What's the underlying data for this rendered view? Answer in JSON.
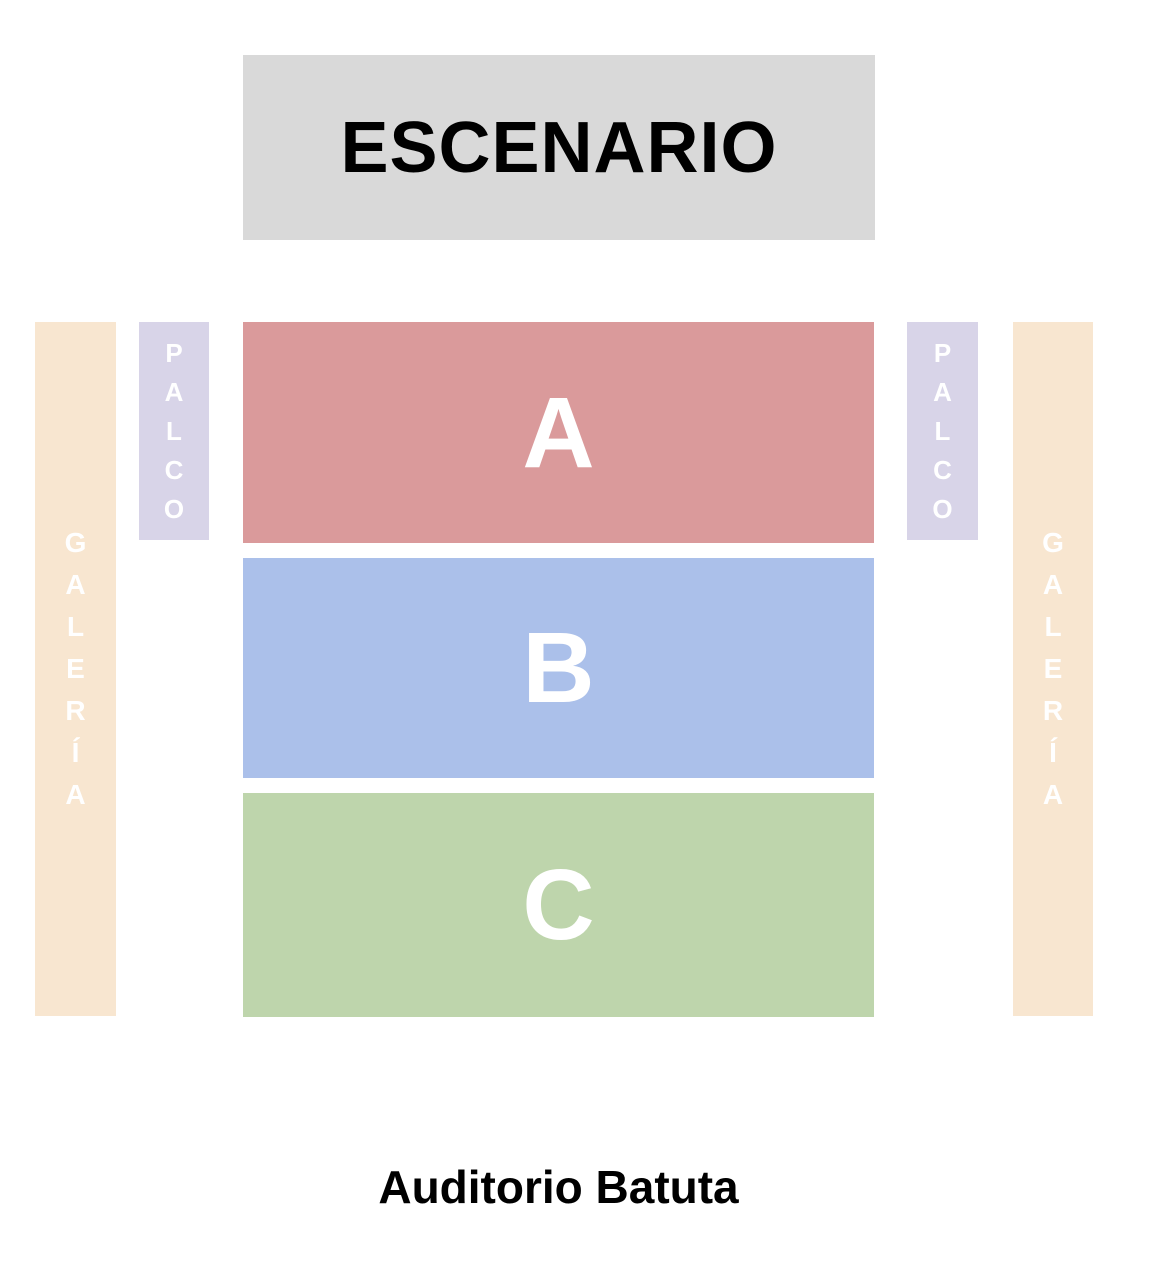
{
  "venue": {
    "name": "Auditorio Batuta"
  },
  "stage": {
    "label": "ESCENARIO",
    "bg_color": "#d9d9d9",
    "text_color": "#000000"
  },
  "sections": [
    {
      "id": "A",
      "label": "A",
      "color": "#da9a9b"
    },
    {
      "id": "B",
      "label": "B",
      "color": "#abc0ea"
    },
    {
      "id": "C",
      "label": "C",
      "color": "#bed5ac"
    }
  ],
  "side_zones": {
    "palco": {
      "label": "PALCO",
      "color": "#d8d4e8"
    },
    "galeria": {
      "label": "GALERÍA",
      "color": "#f8e6d0"
    }
  },
  "zone_label_color": "#ffffff"
}
